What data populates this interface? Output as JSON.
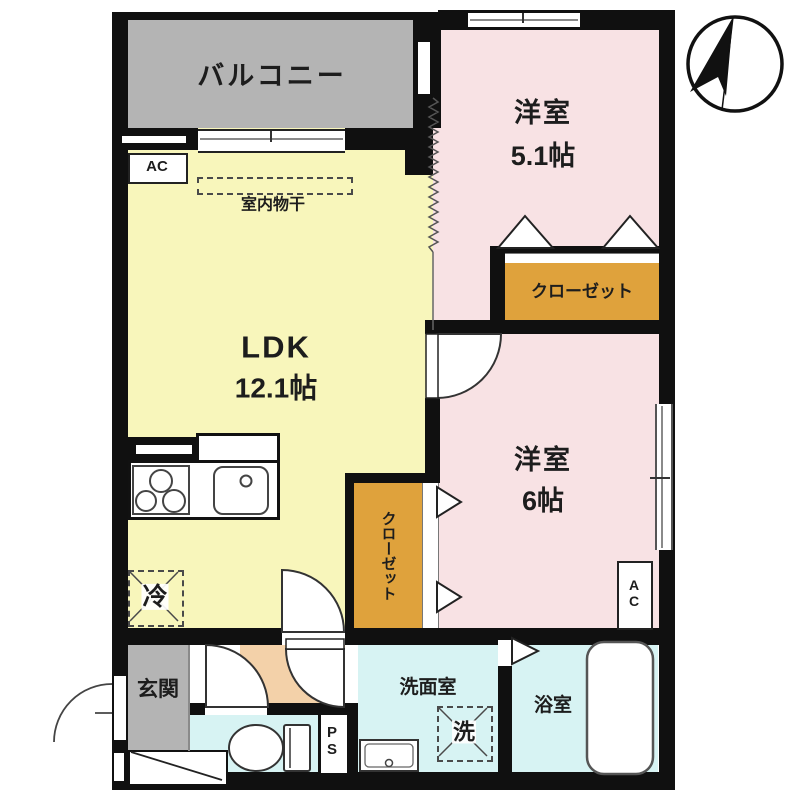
{
  "plan_title": "apartment-floor-plan",
  "rooms": {
    "balcony": {
      "label": "バルコニー"
    },
    "bedroom1": {
      "label": "洋室",
      "size": "5.1帖"
    },
    "closet1": {
      "label": "クローゼット"
    },
    "ldk": {
      "label": "LDK",
      "size": "12.1帖"
    },
    "indoor_drying": {
      "label": "室内物干"
    },
    "ac_ldk": {
      "label": "AC"
    },
    "bedroom2": {
      "label": "洋室",
      "size": "6帖"
    },
    "closet2": {
      "label": "クローゼット"
    },
    "ac_bedroom2": {
      "label": "AC"
    },
    "refrigerator": {
      "label": "冷"
    },
    "entrance": {
      "label": "玄関"
    },
    "pipe_space": {
      "label": "PS"
    },
    "washroom": {
      "label": "洗面室"
    },
    "washing_machine": {
      "label": "洗"
    },
    "bathroom": {
      "label": "浴室"
    }
  },
  "colors": {
    "wall": "#101010",
    "balcony_floor": "#b4b4b4",
    "entrance_floor": "#b4b4b4",
    "ldk_floor": "#f8f6bb",
    "bedroom_floor": "#f8e2e4",
    "closet_fill": "#dfa23c",
    "wet_area_floor": "#d7f3f3",
    "hallway_floor": "#f3d1a9"
  }
}
